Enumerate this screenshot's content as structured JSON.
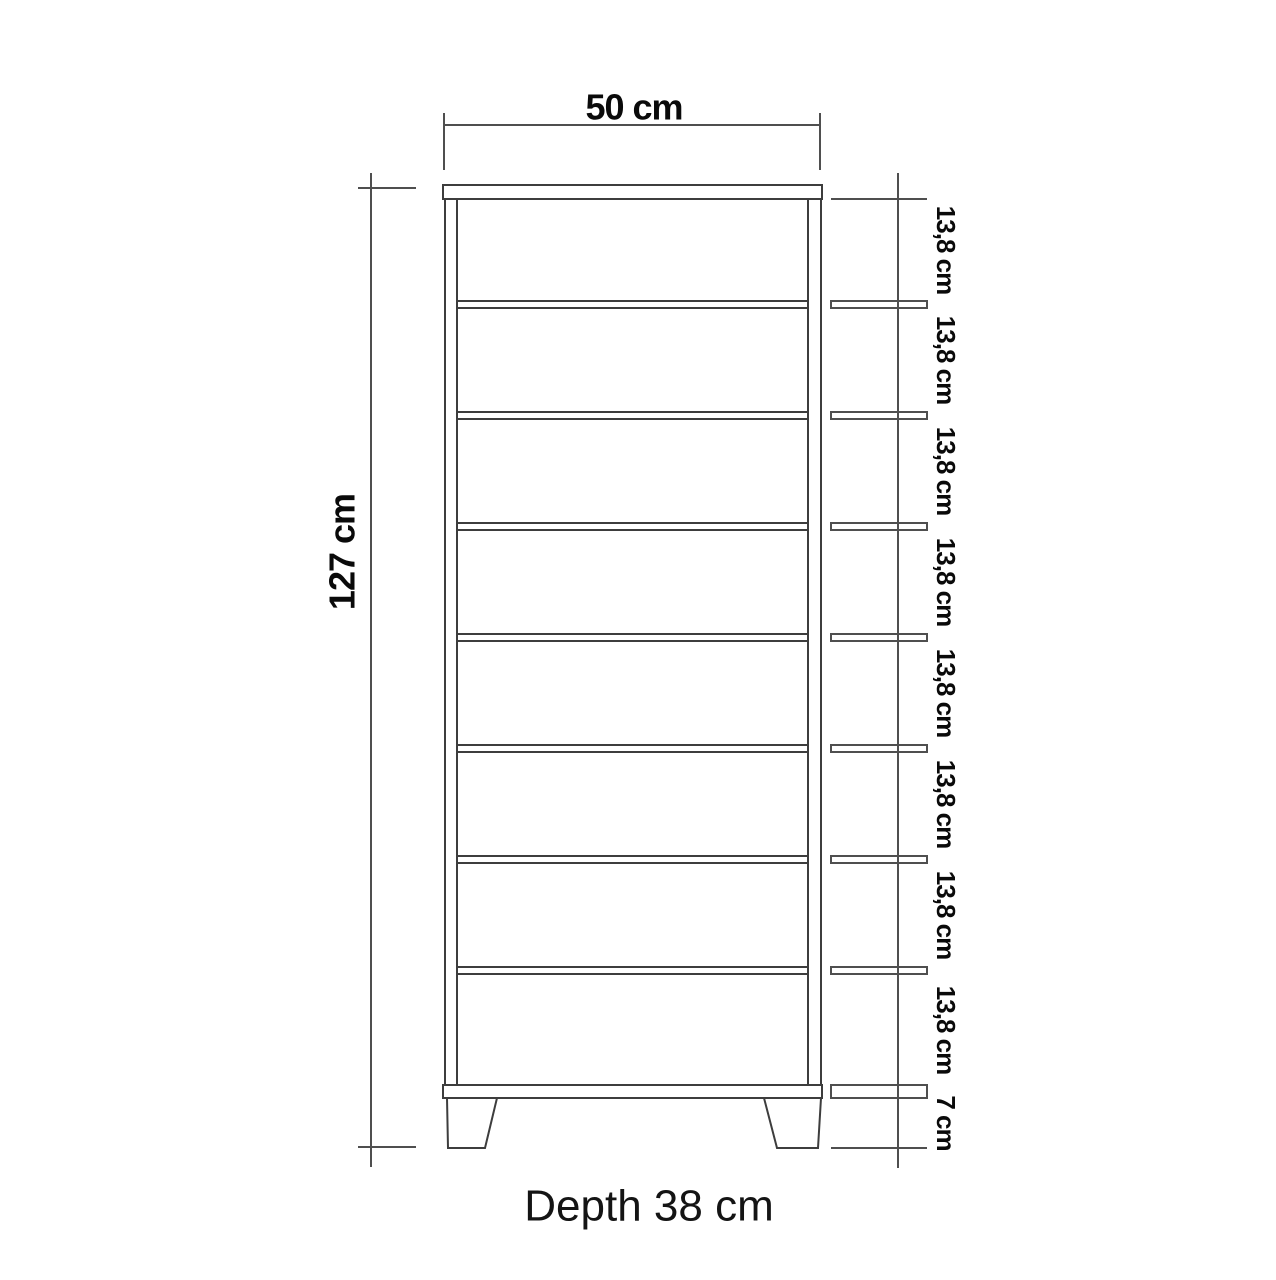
{
  "dimensions": {
    "width": {
      "label": "50 cm"
    },
    "height": {
      "label": "127 cm"
    },
    "depth": {
      "label": "Depth 38 cm"
    },
    "compartments": [
      {
        "label": "13,8 cm"
      },
      {
        "label": "13,8 cm"
      },
      {
        "label": "13,8 cm"
      },
      {
        "label": "13,8 cm"
      },
      {
        "label": "13,8 cm"
      },
      {
        "label": "13,8 cm"
      },
      {
        "label": "13,8 cm"
      },
      {
        "label": "13,8 cm"
      }
    ],
    "base_height": {
      "label": "7 cm"
    }
  },
  "colors": {
    "background": "#ffffff",
    "object_line": "#3d3d3d",
    "dimension_line": "#4f4f4f",
    "text": "#0a0a0a"
  }
}
